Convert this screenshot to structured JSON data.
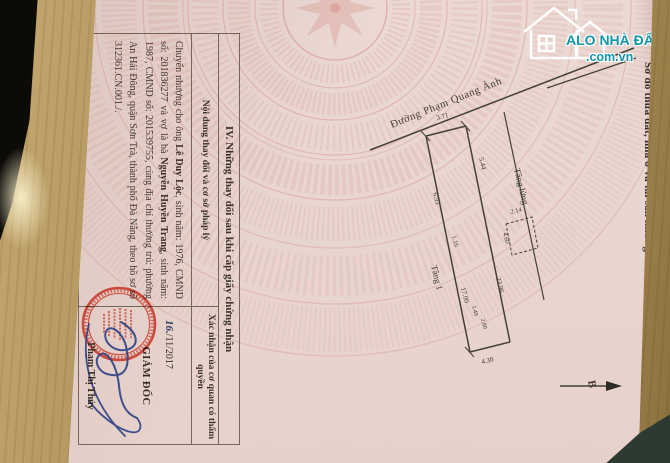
{
  "colors": {
    "paper_pink": "#ebd8d3",
    "watermark_pink": "#c96b62",
    "logo_teal": "#1095ab",
    "seal_red": "#c8382a",
    "signature_blue": "#2e4086",
    "wood_tan": "#b99c62"
  },
  "watermark_logo": {
    "title": "ALO NHÀ ĐẤT",
    "domain": ".com.vn"
  },
  "certificate": {
    "section3_heading": "Sơ đồ thửa đất, nhà ở và tài sản khác gắn liền với đất",
    "section4": {
      "heading": "IV. Những thay đổi sau khi cấp giấy chứng nhận",
      "column_content": "Nội dung thay đổi và cơ sở pháp lý",
      "column_confirmation": "Xác nhận của cơ quan có thẩm quyền",
      "entry_segments": [
        {
          "text": "Chuyển nhượng cho ông ",
          "bold": false
        },
        {
          "text": "Lê Duy Lộc",
          "bold": true
        },
        {
          "text": ", sinh năm: 1976, CMND số: 201836277 và vợ là bà ",
          "bold": false
        },
        {
          "text": "Nguyễn Huyền Trang",
          "bold": true
        },
        {
          "text": ", sinh năm: 1987, CMND số: 201539755, cùng địa chỉ thường trú: phường An Hải Đông, quận Sơn Trà, thành phố Đà Nẵng, theo hồ sơ số 312361.CN.001./.",
          "bold": false
        }
      ],
      "confirmation": {
        "date_day_handwritten": "16.",
        "date_printed": "/11/2017",
        "title": "GIÁM ĐỐC",
        "signer_name": "Phạm Thị Thủy"
      }
    }
  },
  "diagram": {
    "street_name": "Đường Phạm Quang Ảnh",
    "north_label": "B",
    "floor_labels": {
      "mezzanine": "Tầng lửng",
      "first": "Tầng 1"
    },
    "measurements": {
      "frontage": "3.71",
      "right_upper": "5.44",
      "left_upper": "6.93",
      "inset": "1.16",
      "left_side": "17.00",
      "right_side": "23.96",
      "box_top": "2.14",
      "box_side": "4.60",
      "notch_a": "1.49",
      "notch_b": "2.80",
      "bottom": "4.30"
    }
  }
}
